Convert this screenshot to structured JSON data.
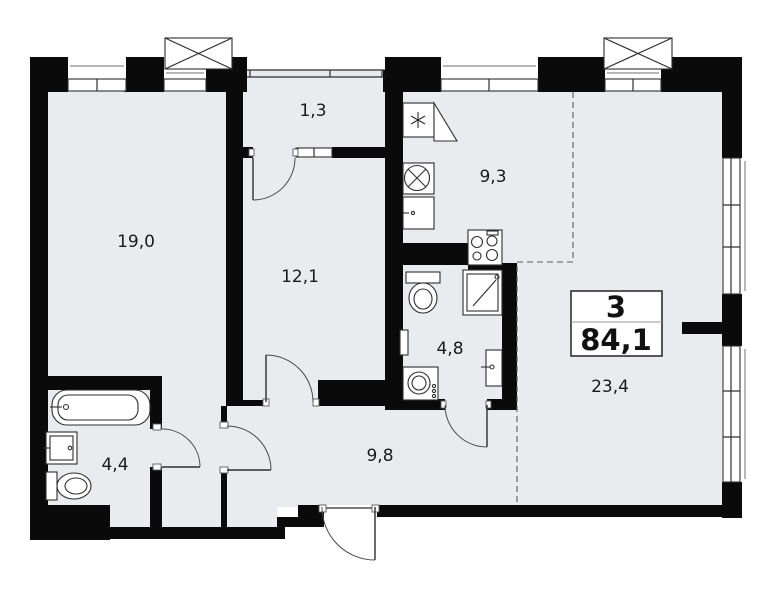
{
  "plan_title": "apartment-floor-plan",
  "info_box": {
    "rooms_count": "3",
    "total_area": "84,1"
  },
  "rooms": [
    {
      "id": "bedroom-1",
      "label": "19,0"
    },
    {
      "id": "balcony",
      "label": "1,3"
    },
    {
      "id": "bedroom-2",
      "label": "12,1"
    },
    {
      "id": "kitchen",
      "label": "9,3"
    },
    {
      "id": "bathroom-2",
      "label": "4,8"
    },
    {
      "id": "living-room",
      "label": "23,4"
    },
    {
      "id": "hallway",
      "label": "9,8"
    },
    {
      "id": "bathroom-1",
      "label": "4,4"
    }
  ],
  "colors": {
    "wall": "#0a0a0a",
    "floor": "#e9ebee",
    "outline": "#2e2e2e",
    "background": "#ffffff"
  },
  "fixtures": [
    "bathtub",
    "sink",
    "toilet",
    "washing-machine",
    "shower",
    "towel-rail",
    "fridge",
    "kitchen-sink",
    "kitchen-cabinet",
    "stove",
    "ventilation-shaft",
    "window",
    "door"
  ]
}
